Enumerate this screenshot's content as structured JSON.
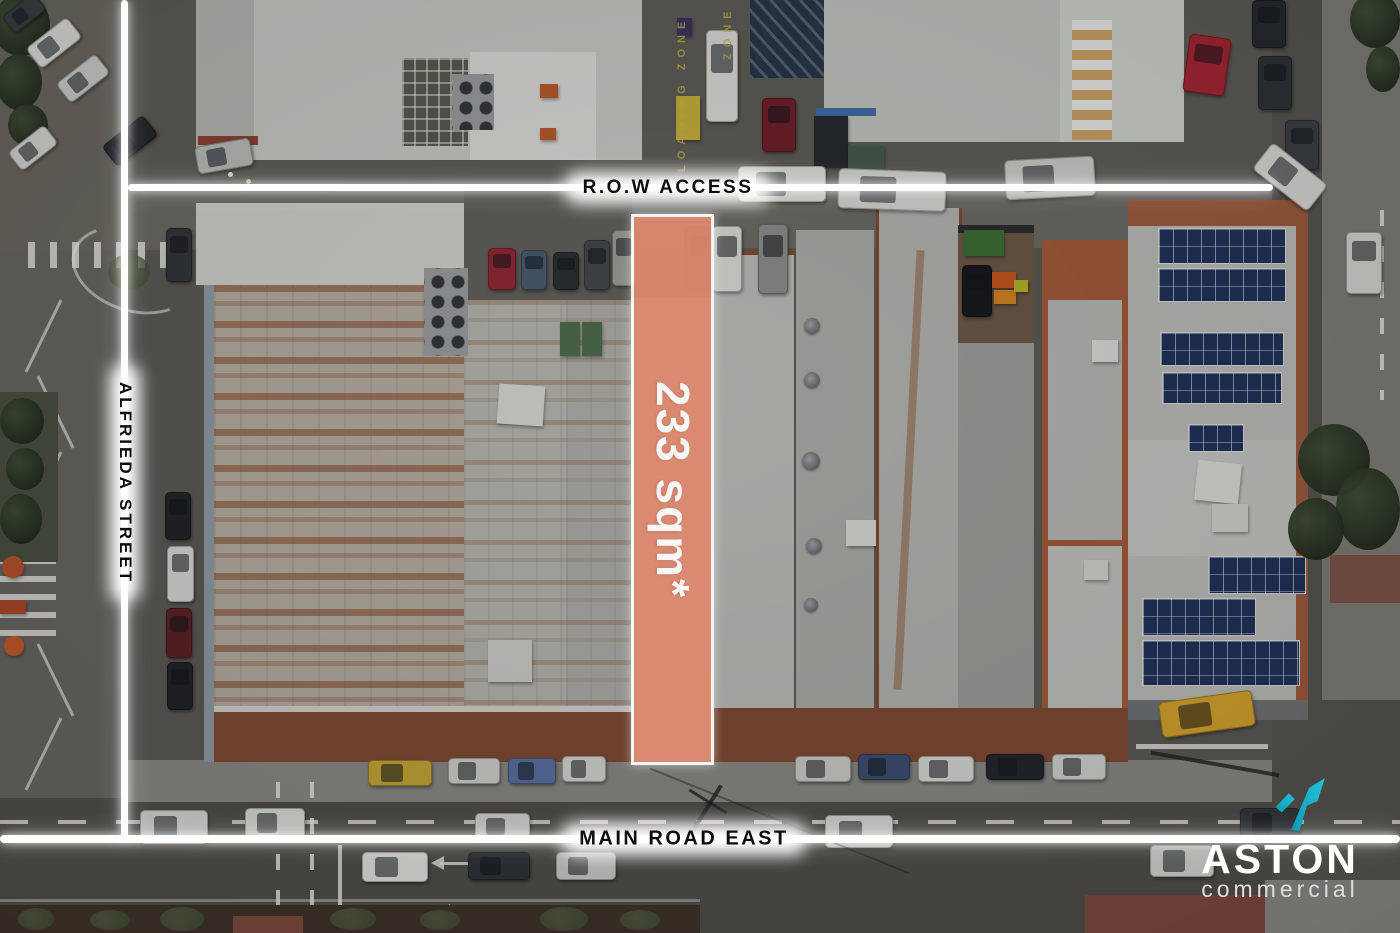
{
  "overlay": {
    "row_access_label": "R.O.W ACCESS",
    "side_street_label": "ALFRIEDA STREET",
    "main_road_label": "MAIN ROAD EAST",
    "area_label": "233 sqm*",
    "highlight_color": "#E08A6E",
    "boundary_color": "#FFFFFF",
    "label_text_color": "#0D0D0D"
  },
  "road_markings": {
    "loading_zone_text": "LOADING ZONE",
    "zone_text": "ZONE"
  },
  "logo": {
    "brand": "ASTON",
    "subtitle": "commercial",
    "arrow_color": "#17AEC6",
    "brand_color": "#FFFFFF",
    "subtitle_color": "#DDDEDC"
  }
}
